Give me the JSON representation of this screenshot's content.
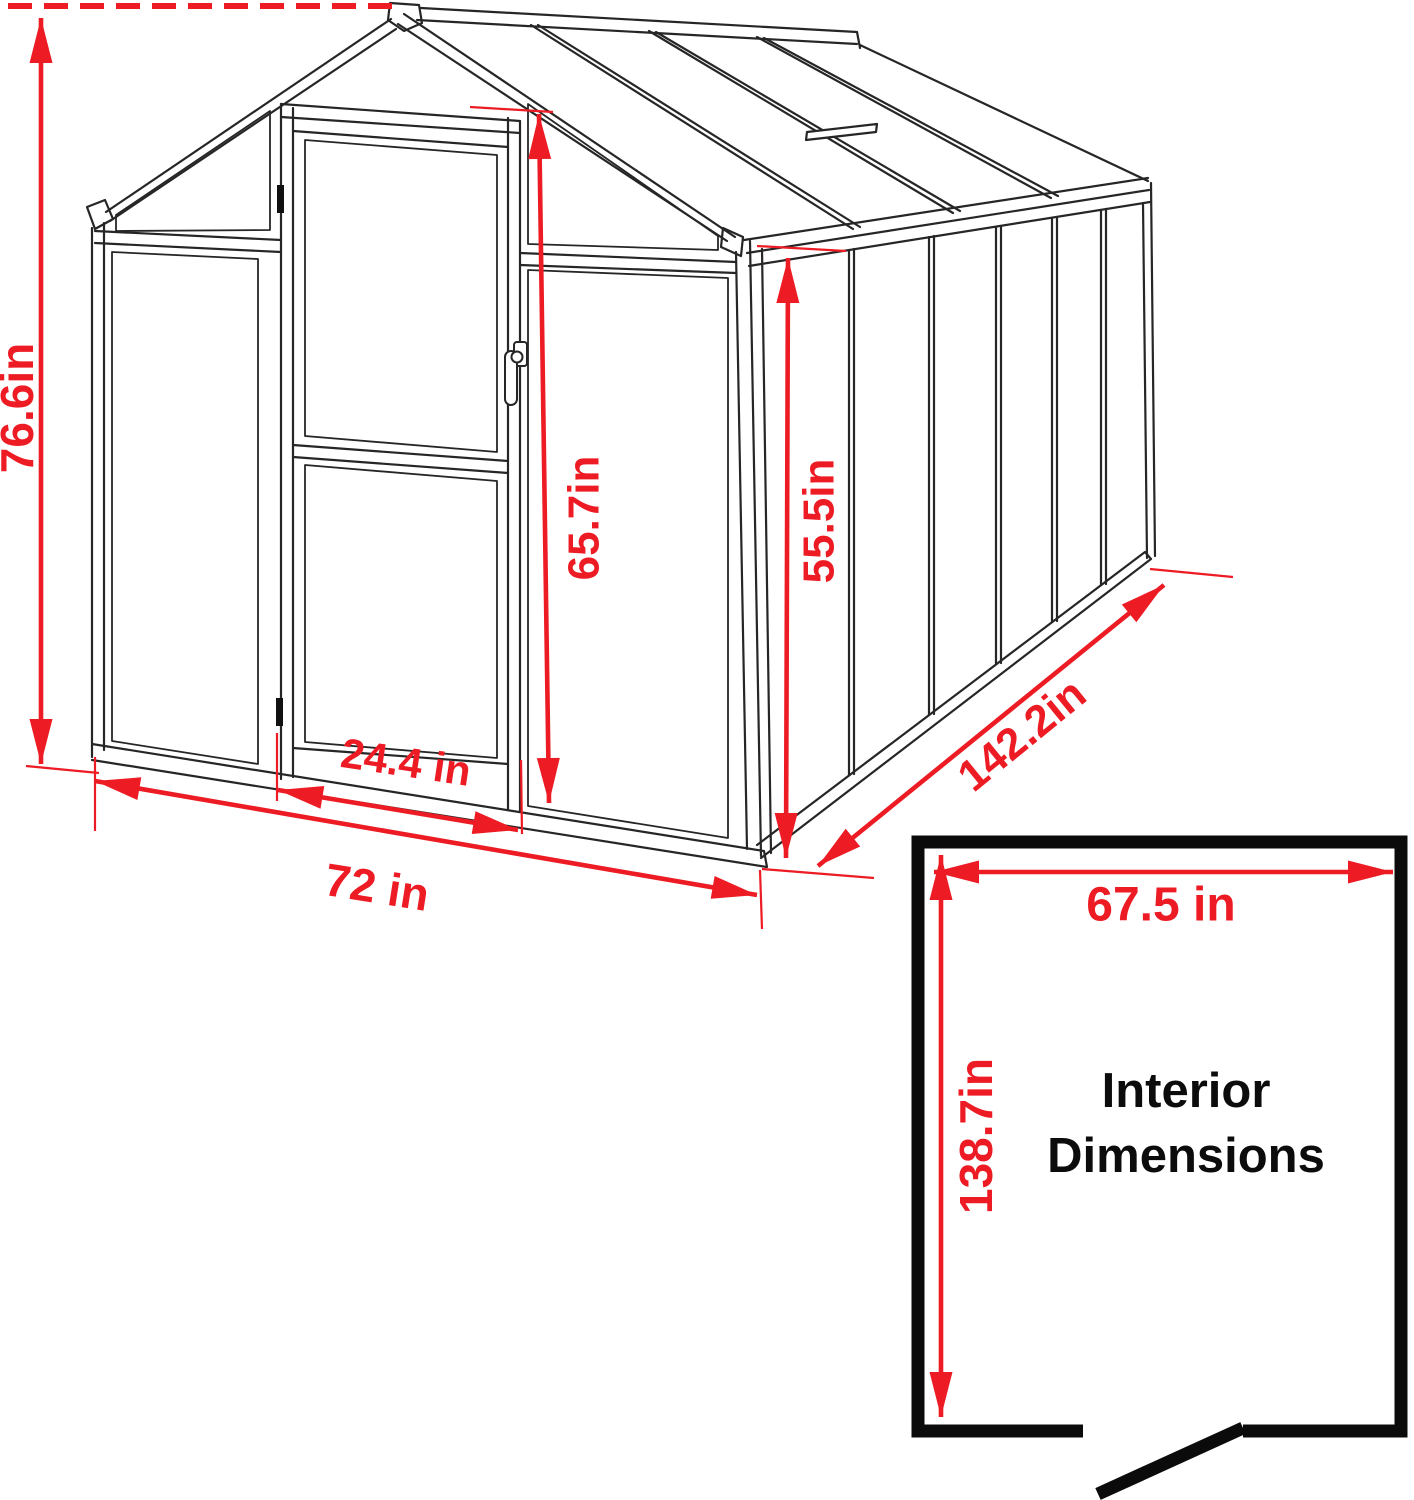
{
  "figure": {
    "type": "greenhouse-dimension-diagram",
    "background": "#ffffff",
    "accent_red": "#ed1c24",
    "ink": "#262626",
    "wall_black": "#0b0b0b"
  },
  "interior_box": {
    "title_line1": "Interior",
    "title_line2": "Dimensions"
  },
  "dashed_line": {
    "x1": 8,
    "y1": 6,
    "x2": 396,
    "y2": 6
  },
  "dimensions": [
    {
      "id": "overall-height",
      "label": "76.6in",
      "x1": 41,
      "y1": 18,
      "x2": 41,
      "y2": 764,
      "lx": 17,
      "ly": 408,
      "rot": -90,
      "fs": 46
    },
    {
      "id": "door-height",
      "label": "65.7in",
      "x1": 539,
      "y1": 114,
      "x2": 549,
      "y2": 803,
      "lx": 584,
      "ly": 518,
      "rot": -90,
      "fs": 44
    },
    {
      "id": "side-wall-height",
      "label": "55.5in",
      "x1": 788,
      "y1": 258,
      "x2": 786,
      "y2": 858,
      "lx": 819,
      "ly": 521,
      "rot": -90,
      "fs": 44
    },
    {
      "id": "door-width",
      "label": "24.4 in",
      "x1": 278,
      "y1": 790,
      "x2": 518,
      "y2": 830,
      "lx": 406,
      "ly": 762,
      "rot": 8.5,
      "fs": 42
    },
    {
      "id": "front-width",
      "label": "72 in",
      "x1": 95,
      "y1": 781,
      "x2": 757,
      "y2": 895,
      "lx": 377,
      "ly": 887,
      "rot": 9,
      "fs": 46
    },
    {
      "id": "depth",
      "label": "142.2in",
      "x1": 818,
      "y1": 866,
      "x2": 1164,
      "y2": 585,
      "lx": 1022,
      "ly": 735,
      "rot": -39.2,
      "fs": 44
    },
    {
      "id": "interior-width",
      "label": "67.5 in",
      "x1": 934,
      "y1": 872,
      "x2": 1393,
      "y2": 872,
      "lx": 1161,
      "ly": 905,
      "rot": 0,
      "fs": 48
    },
    {
      "id": "interior-depth",
      "label": "138.7in",
      "x1": 941,
      "y1": 855,
      "x2": 941,
      "y2": 1417,
      "lx": 976,
      "ly": 1136,
      "rot": -90,
      "fs": 46
    }
  ],
  "extension_lines": [
    {
      "x1": 26,
      "y1": 766,
      "x2": 99,
      "y2": 773
    },
    {
      "x1": 95,
      "y1": 757,
      "x2": 95,
      "y2": 831
    },
    {
      "x1": 470,
      "y1": 107,
      "x2": 553,
      "y2": 112
    },
    {
      "x1": 757,
      "y1": 246,
      "x2": 846,
      "y2": 251
    },
    {
      "x1": 762,
      "y1": 869,
      "x2": 874,
      "y2": 878
    },
    {
      "x1": 760,
      "y1": 870,
      "x2": 762,
      "y2": 929
    },
    {
      "x1": 1150,
      "y1": 569,
      "x2": 1233,
      "y2": 577
    },
    {
      "x1": 277,
      "y1": 733,
      "x2": 277,
      "y2": 801
    },
    {
      "x1": 521,
      "y1": 760,
      "x2": 522,
      "y2": 834
    }
  ],
  "arrow": {
    "length": 45,
    "half_width": 11.5,
    "line_width": 4.6,
    "ext_width": 2.2
  }
}
